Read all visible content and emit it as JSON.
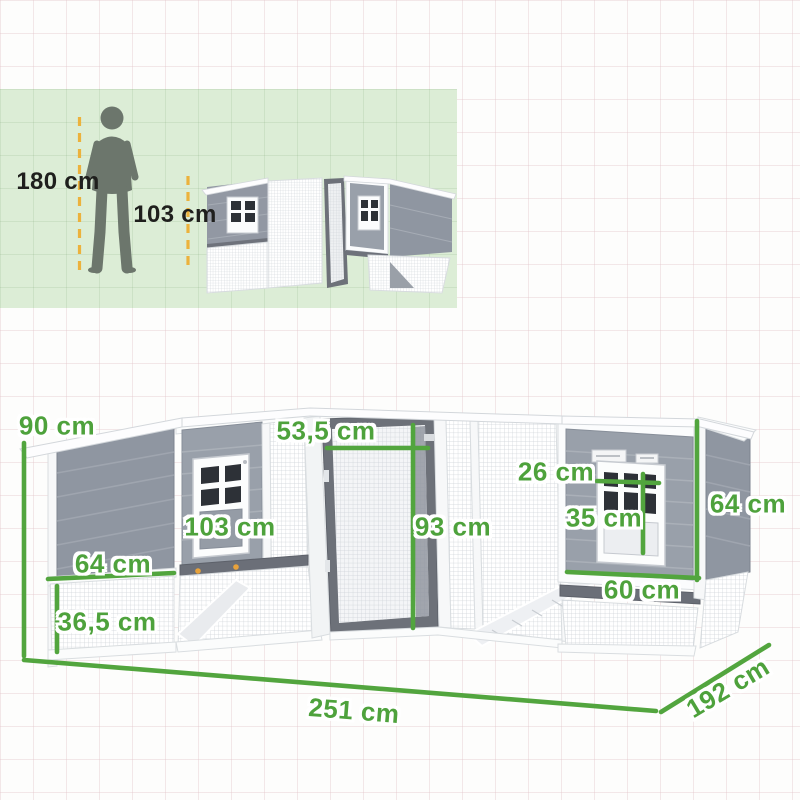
{
  "scale_panel": {
    "person_height_label": "180 cm",
    "coop_height_label": "103 cm"
  },
  "dimensions": {
    "overall_height": "90 cm",
    "left_panel_width": "64 cm",
    "run_height": "36,5 cm",
    "coop_height": "103 cm",
    "door_width": "53,5 cm",
    "door_height": "93 cm",
    "window_width": "26 cm",
    "window_height": "35 cm",
    "right_side_height": "64 cm",
    "right_house_width": "60 cm",
    "total_length": "251 cm",
    "total_depth": "192 cm"
  },
  "colors": {
    "dimension_green": "#4ea23c",
    "guide_yellow": "#ecb23c",
    "panel_background": "#dcedd6",
    "wood_gray": "#8f96a1",
    "dark_pane": "#2d3137",
    "accent_orange_bolt": "#e8a23b"
  }
}
